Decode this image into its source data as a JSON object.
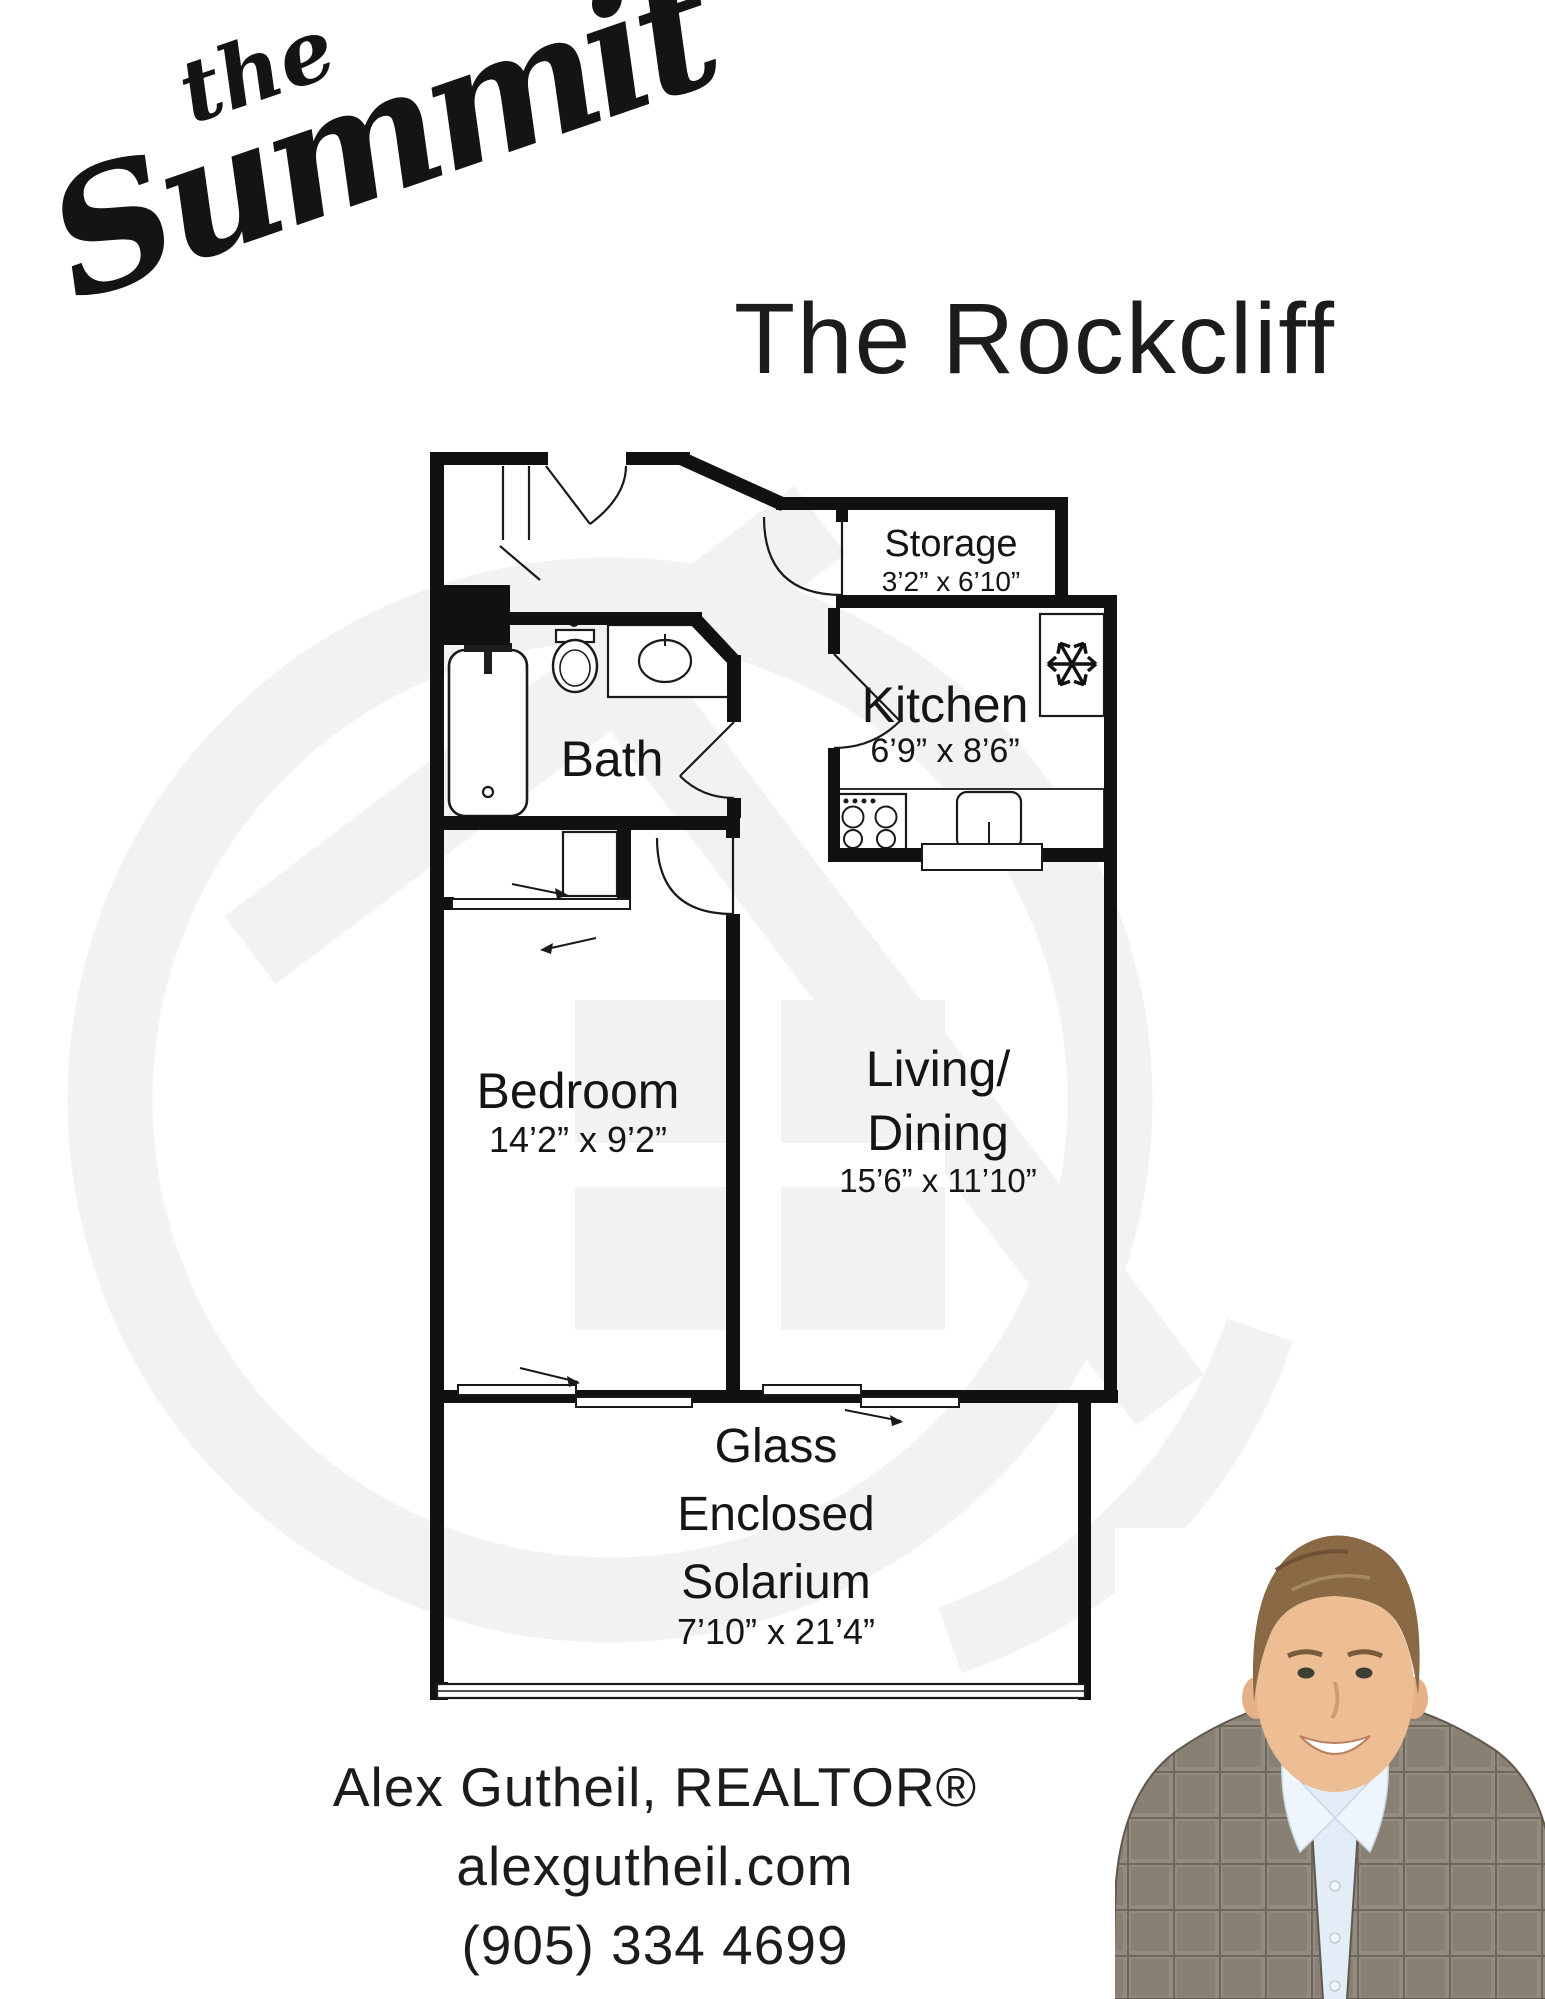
{
  "logo": {
    "word_small": "the",
    "word_large": "Summit"
  },
  "header": {
    "title": "The Rockcliff"
  },
  "floorplan": {
    "rooms": {
      "storage": {
        "name": "Storage",
        "dims": "3’2” x 6’10”"
      },
      "kitchen": {
        "name": "Kitchen",
        "dims": "6’9” x 8’6”"
      },
      "bath": {
        "name": "Bath"
      },
      "bedroom": {
        "name": "Bedroom",
        "dims": "14’2” x 9’2”"
      },
      "living_dining": {
        "name_line1": "Living/",
        "name_line2": "Dining",
        "dims": "15’6” x 11’10”"
      },
      "solarium": {
        "name_line1": "Glass",
        "name_line2": "Enclosed",
        "name_line3": "Solarium",
        "dims": "7’10” x 21’4”"
      }
    },
    "icons": {
      "freezer": "snowflake-icon",
      "fixtures": [
        "bathtub-icon",
        "toilet-icon",
        "vanity-sink-icon",
        "stove-icon",
        "kitchen-sink-icon",
        "fridge-icon"
      ]
    }
  },
  "footer": {
    "agent": "Alex Gutheil, REALTOR®",
    "website": "alexgutheil.com",
    "phone": "(905) 334 4699"
  },
  "colors": {
    "ink": "#111111",
    "text": "#1b1b1b",
    "watermark": "#f2f2f2"
  }
}
